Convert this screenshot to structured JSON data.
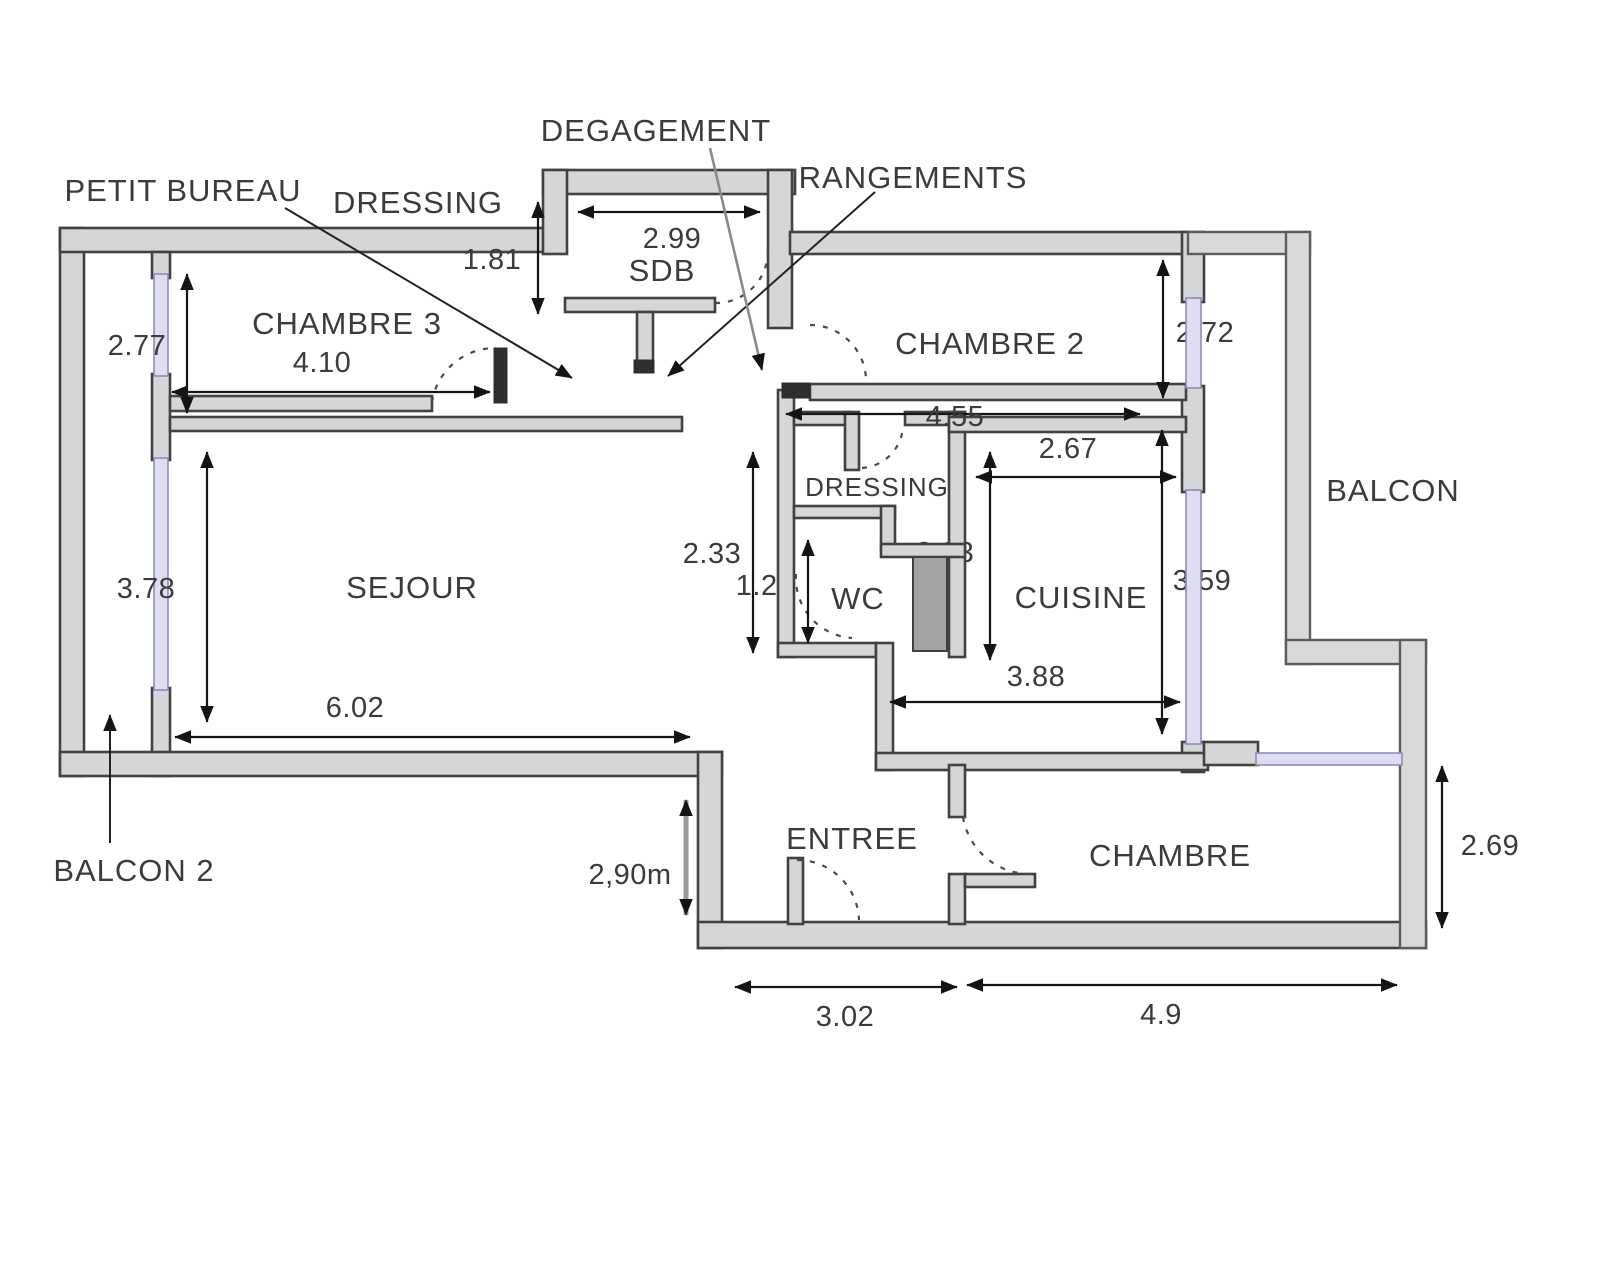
{
  "labels": {
    "petit_bureau": "PETIT BUREAU",
    "dressing_top": "DRESSING",
    "degagement": "DEGAGEMENT",
    "rangements": "RANGEMENTS",
    "chambre3": "CHAMBRE 3",
    "sdb": "SDB",
    "chambre2": "CHAMBRE 2",
    "dressing_small": "DRESSING",
    "wc": "WC",
    "cuisine": "CUISINE",
    "sejour": "SEJOUR",
    "balcon": "BALCON",
    "balcon2": "BALCON 2",
    "entree": "ENTREE",
    "chambre": "CHAMBRE"
  },
  "dimensions": {
    "chambre3_height": "2.77",
    "chambre3_width": "4.10",
    "dressing_depth": "1.81",
    "sdb_width": "2.99",
    "chambre2_window": "2.72",
    "chambre2_width": "4.55",
    "cuisine_width": "2.67",
    "cuisine_window_height": "3.59",
    "passage_height": "2.33",
    "wc_height": "1.25",
    "shaft_width": "2.33",
    "sejour_width": "6.02",
    "sejour_height": "3.78",
    "entree_height": "2,90m",
    "entree_width": "3.02",
    "chambre_width": "4.9",
    "chambre_height": "2.69",
    "cuisine_total_width": "3.88"
  }
}
